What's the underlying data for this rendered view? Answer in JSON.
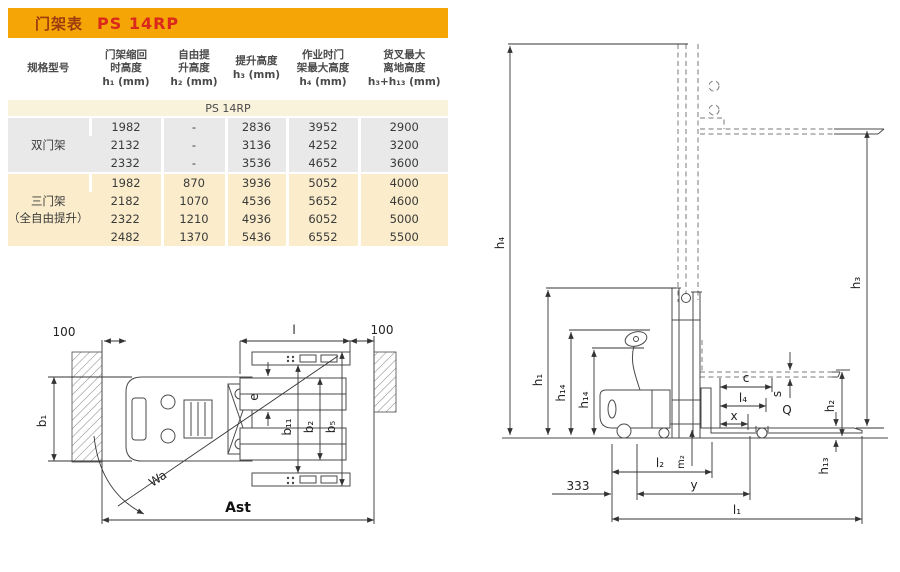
{
  "colors": {
    "header_bar": "#F5A505",
    "title_text": "#9E3A0F",
    "model_text": "#DA291C",
    "row_gray": "#E9E9E9",
    "row_cream": "#FBEDCB",
    "subheader_cream": "#FAF3DC",
    "line": "#444444"
  },
  "table": {
    "title_label": "门架表",
    "title_model": "PS 14RP",
    "headers": [
      "规格型号",
      "门架缩回\n时高度\nh₁ (mm)",
      "自由提\n升高度\nh₂ (mm)",
      "提升高度\nh₃ (mm)",
      "作业时门\n架最大高度\nh₄ (mm)",
      "货叉最大\n离地高度\nh₃+h₁₃ (mm)"
    ],
    "subheader": "PS 14RP",
    "sections": [
      {
        "label": "双门架",
        "rows": [
          [
            "1982",
            "-",
            "2836",
            "3952",
            "2900"
          ],
          [
            "2132",
            "-",
            "3136",
            "4252",
            "3200"
          ],
          [
            "2332",
            "-",
            "3536",
            "4652",
            "3600"
          ]
        ]
      },
      {
        "label": "三门架\n（全自由提升）",
        "rows": [
          [
            "1982",
            "870",
            "3936",
            "5052",
            "4000"
          ],
          [
            "2182",
            "1070",
            "4536",
            "5652",
            "4600"
          ],
          [
            "2322",
            "1210",
            "4936",
            "6052",
            "5000"
          ],
          [
            "2482",
            "1370",
            "5436",
            "6552",
            "5500"
          ]
        ]
      }
    ]
  },
  "top_view": {
    "labels": {
      "clearance_left": "100",
      "fork_length": "l",
      "clearance_right": "100",
      "b1": "b₁",
      "e": "e",
      "b11": "b₁₁",
      "b2": "b₂",
      "b5": "b₅",
      "wa": "Wa",
      "ast": "Ast"
    }
  },
  "side_view": {
    "labels": {
      "h4": "h₄",
      "h1": "h₁",
      "h14a": "h₁₄",
      "h14b": "h₁₄",
      "h3": "h₃",
      "h2": "h₂",
      "h13": "h₁₃",
      "c": "c",
      "l4": "l₄",
      "x": "x",
      "s": "s",
      "q": "Q",
      "dim333": "333",
      "l2": "l₂",
      "m2": "m₂",
      "y": "y",
      "l1": "l₁"
    }
  }
}
